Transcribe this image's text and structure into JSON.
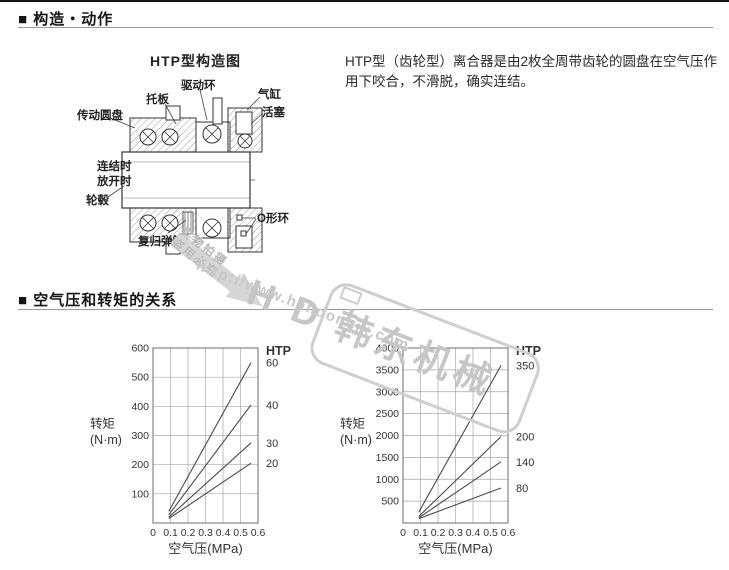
{
  "header": {
    "marker": "■",
    "section1": "构造・动作",
    "section2": "空气压和转矩的关系"
  },
  "intro": {
    "text": "HTP型（齿轮型）离合器是由2枚全周带齿轮的圆盘在空气压作用下咬合，不滑脱，确实连结。"
  },
  "diagram": {
    "title": "HTP型构造图",
    "labels": {
      "tuoban": "托板",
      "qudonghuan": "驱动环",
      "qigang": "气缸",
      "huosai": "活塞",
      "chuandongyuanpan": "传动圆盘",
      "lianjieshi": "连结时",
      "fangkaishi": "放开时",
      "lungu": "轮毂",
      "oxinghuan": "O形环",
      "fuguitanhuang": "复归弹簧"
    }
  },
  "watermark": {
    "stamp_line1": "实物拍摄",
    "stamp_line2": "盗用必究",
    "url": "http://www.handongjx.com",
    "brand": "H D 韩东机械"
  },
  "chart_data": [
    {
      "type": "line",
      "legend_title": "HTP",
      "xlabel": "空气压(MPa)",
      "ylabel": "转矩",
      "ylabel2": "(N·m)",
      "xlim": [
        0,
        0.6
      ],
      "ylim": [
        0,
        600
      ],
      "xticks": [
        "0",
        "0.1",
        "0.2",
        "0.3",
        "0.4",
        "0.5",
        "0.6"
      ],
      "yticks": [
        "100",
        "200",
        "300",
        "400",
        "500",
        "600"
      ],
      "grid": true,
      "series": [
        {
          "name": "60",
          "points": [
            [
              0.09,
              40
            ],
            [
              0.56,
              550
            ]
          ]
        },
        {
          "name": "40",
          "points": [
            [
              0.09,
              28
            ],
            [
              0.56,
              405
            ]
          ]
        },
        {
          "name": "30",
          "points": [
            [
              0.09,
              20
            ],
            [
              0.56,
              275
            ]
          ]
        },
        {
          "name": "20",
          "points": [
            [
              0.09,
              15
            ],
            [
              0.56,
              205
            ]
          ]
        }
      ]
    },
    {
      "type": "line",
      "legend_title": "HTP",
      "xlabel": "空气压(MPa)",
      "ylabel": "转矩",
      "ylabel2": "(N·m)",
      "xlim": [
        0,
        0.6
      ],
      "ylim": [
        0,
        4000
      ],
      "xticks": [
        "0",
        "0.1",
        "0.2",
        "0.3",
        "0.4",
        "0.5",
        "0.6"
      ],
      "yticks": [
        "500",
        "1000",
        "1500",
        "2000",
        "2500",
        "3000",
        "3500",
        "4000"
      ],
      "grid": true,
      "series": [
        {
          "name": "350",
          "points": [
            [
              0.09,
              250
            ],
            [
              0.56,
              3600
            ]
          ]
        },
        {
          "name": "200",
          "points": [
            [
              0.09,
              150
            ],
            [
              0.56,
              1975
            ]
          ]
        },
        {
          "name": "140",
          "points": [
            [
              0.09,
              120
            ],
            [
              0.56,
              1400
            ]
          ]
        },
        {
          "name": "80",
          "points": [
            [
              0.09,
              100
            ],
            [
              0.56,
              800
            ]
          ]
        }
      ]
    }
  ]
}
